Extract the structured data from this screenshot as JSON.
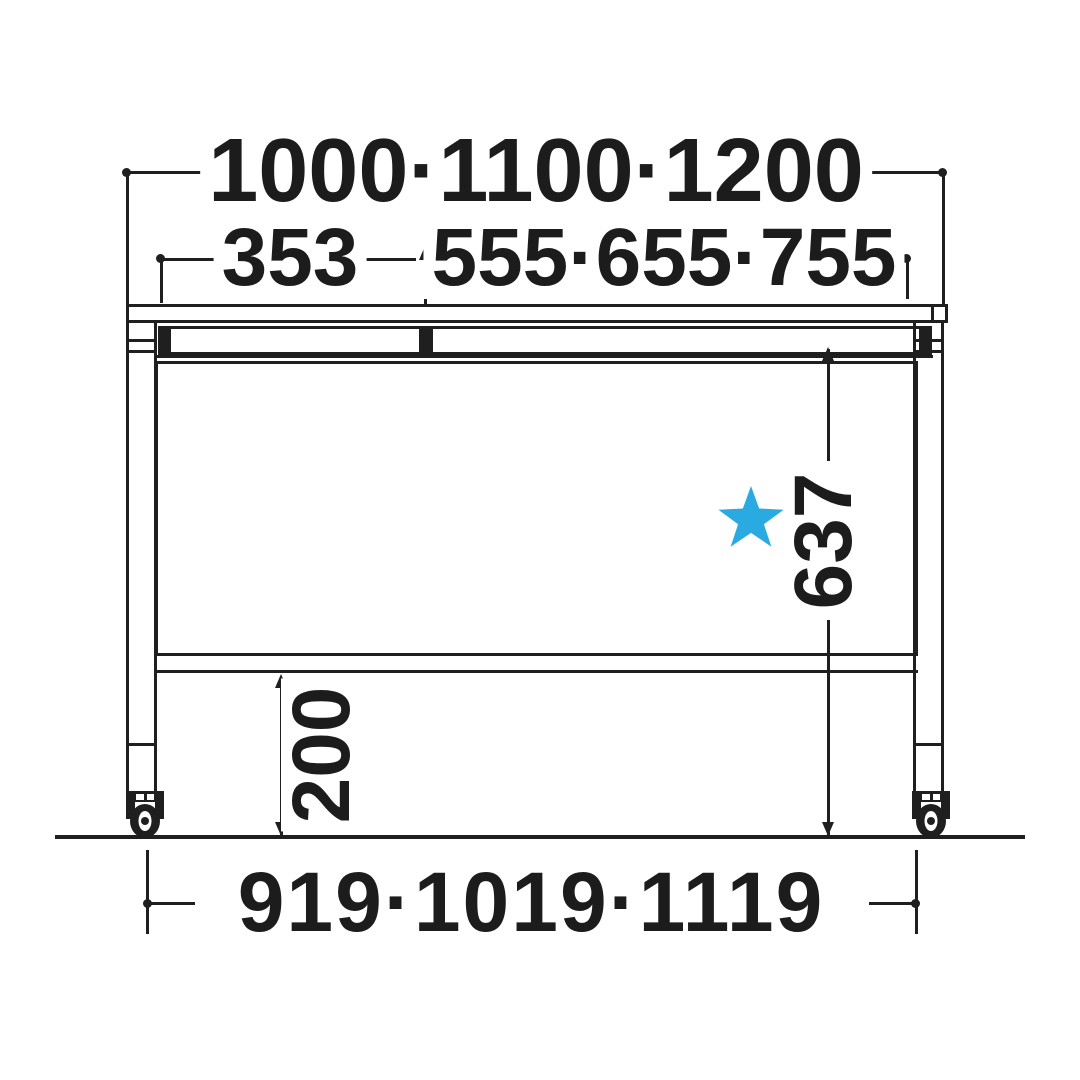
{
  "diagram": {
    "type": "furniture-dimension-drawing",
    "view": "front-elevation-of-table-on-casters"
  },
  "dimensions": {
    "overall_width": "1000·1100·1200",
    "left_section_width": "353",
    "right_section_width": "555·655·755",
    "underside_height": "637",
    "bottom_clearance": "200",
    "caster_span": "919·1019·1119"
  },
  "marker": {
    "star_color": "#29ABE2",
    "star_meaning": "option-marker"
  },
  "colors": {
    "line": "#1f1f1f",
    "background": "#ffffff",
    "text": "#1c1c1c"
  }
}
